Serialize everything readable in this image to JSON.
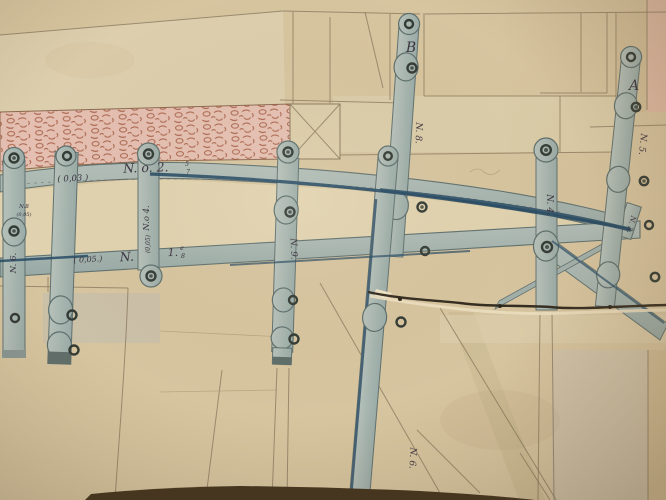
{
  "meta": {
    "description": "Photograph of an antique engineering drawing of iron truss/arch strapwork with numbered wrought-iron bars, rivet holes, masonry hatching, paper fold lines and a horizontal tear",
    "media": "aged paper, ink and wash drawing"
  },
  "colors": {
    "paper": "#d7c5a0",
    "paper_light": "#e2d4b0",
    "strap": "#a9b6b0",
    "strap_edge": "#5f7170",
    "ink_blue": "#264a64",
    "pencil": "#8b7b5f",
    "ink_text": "#3a3340",
    "masonry_bg": "#e5c0b2",
    "masonry_ink": "#9c4f35",
    "table": "#43331d",
    "tear": "#332c20"
  },
  "labels": {
    "point_b": "B",
    "point_a": "A",
    "arch_dim": "( 0,03 )",
    "arch_no": "N. o. 2.",
    "arch_frac_top": "5",
    "arch_frac_bot": "7",
    "chord_dim": "( 0,05.)",
    "chord_no": "N.",
    "chord_no2": "1.",
    "chord_sup_top": "e",
    "chord_sup_bot": "8",
    "bar_left_note1": "N.8",
    "bar_left_note2": "(0,05)",
    "bar_left_no": "N. 6.",
    "bar_m1_no": "N.o 4.",
    "bar_m1_dim": "(0,05)",
    "bar_m2_no": "N. 9.",
    "bar_m3_no": "N. 8.",
    "bar_m4_no": "N. 6.",
    "bar_r1_no": "N. 4.",
    "bar_r2_no": "N. 5.",
    "plate_no": "N. 3."
  }
}
